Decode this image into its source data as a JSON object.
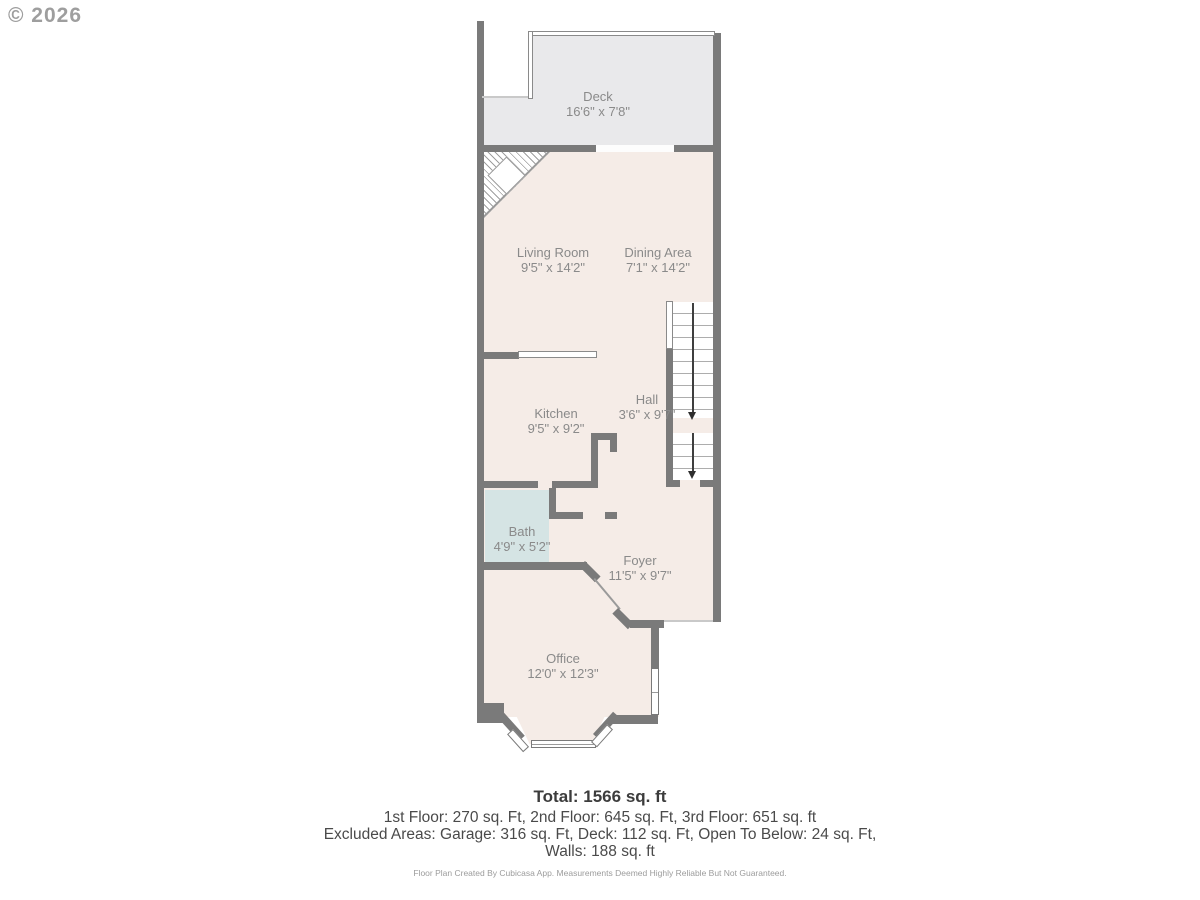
{
  "watermark": "© 2026",
  "rooms": {
    "deck": {
      "name": "Deck",
      "dims": "16'6\" x 7'8\""
    },
    "living_room": {
      "name": "Living Room",
      "dims": "9'5\" x 14'2\""
    },
    "dining_area": {
      "name": "Dining Area",
      "dims": "7'1\" x 14'2\""
    },
    "kitchen": {
      "name": "Kitchen",
      "dims": "9'5\" x 9'2\""
    },
    "hall": {
      "name": "Hall",
      "dims": "3'6\" x 9'7\""
    },
    "bath": {
      "name": "Bath",
      "dims": "4'9\" x 5'2\""
    },
    "foyer": {
      "name": "Foyer",
      "dims": "11'5\" x 9'7\""
    },
    "office": {
      "name": "Office",
      "dims": "12'0\" x 12'3\""
    }
  },
  "summary": {
    "total": "Total: 1566 sq. ft",
    "floors": "1st Floor: 270 sq. Ft, 2nd Floor: 645 sq. Ft, 3rd Floor: 651 sq. ft",
    "excluded": "Excluded Areas: Garage: 316 sq. Ft, Deck: 112 sq. Ft, Open To Below: 24 sq. Ft,",
    "walls": "Walls: 188 sq. ft",
    "disclaimer": "Floor Plan Created By Cubicasa App. Measurements Deemed Highly Reliable But Not Guaranteed."
  },
  "colors": {
    "wall": "#7a7a7a",
    "interior_floor": "#f5ece7",
    "deck_floor": "#e9e9eb",
    "bath_floor": "#d5e4e4",
    "label_text": "#8a8a8a"
  }
}
